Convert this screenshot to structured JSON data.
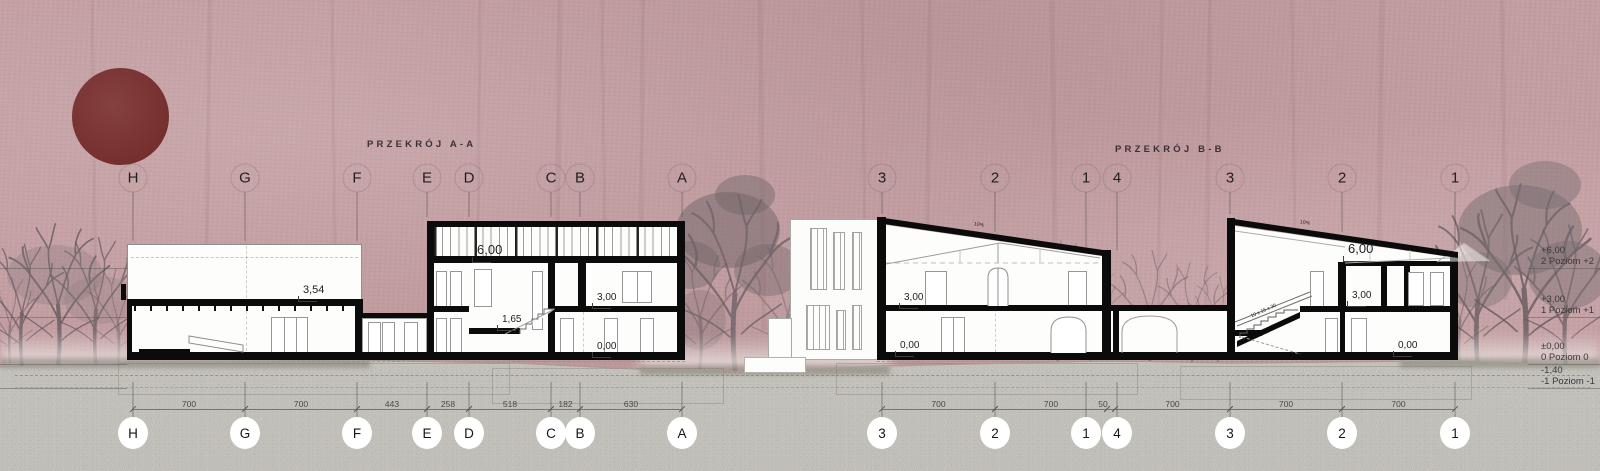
{
  "board": {
    "title_a": "PRZEKRÓJ A-A",
    "title_b": "PRZEKRÓJ B-B"
  },
  "colors": {
    "background": "#c29da0",
    "sun": "#75302f",
    "ink": "#0b0b0b",
    "ground": "#dcdbd6",
    "tree": "#6e6368",
    "birds": "#ecdfae"
  },
  "levels": {
    "rows": [
      {
        "value": "+6,00",
        "name": "2 Poziom +2",
        "y": 245
      },
      {
        "value": "+3,00",
        "name": "1 Poziom +1",
        "y": 294
      },
      {
        "value": "±0,00",
        "name": "0 Poziom 0",
        "y": 341
      },
      {
        "value": "-1,40",
        "name": "-1 Poziom -1",
        "y": 365
      }
    ]
  },
  "section_a": {
    "title_pos": {
      "x": 367,
      "y": 139
    },
    "grids": [
      {
        "label": "H",
        "x": 133,
        "drop": 241
      },
      {
        "label": "G",
        "x": 245,
        "drop": 241
      },
      {
        "label": "F",
        "x": 357,
        "drop": 241
      },
      {
        "label": "E",
        "x": 427,
        "drop": 217
      },
      {
        "label": "D",
        "x": 469,
        "drop": 217
      },
      {
        "label": "C",
        "x": 551,
        "drop": 217
      },
      {
        "label": "B",
        "x": 580,
        "drop": 217
      },
      {
        "label": "A",
        "x": 682,
        "drop": 217
      }
    ],
    "dims": [
      {
        "label": "700",
        "x1": 133,
        "x2": 245
      },
      {
        "label": "700",
        "x1": 245,
        "x2": 357
      },
      {
        "label": "443",
        "x1": 357,
        "x2": 427
      },
      {
        "label": "258",
        "x1": 427,
        "x2": 469
      },
      {
        "label": "518",
        "x1": 469,
        "x2": 551
      },
      {
        "label": "182",
        "x1": 551,
        "x2": 580
      },
      {
        "label": "630",
        "x1": 580,
        "x2": 682
      }
    ],
    "marks": [
      {
        "text": "3,54",
        "x": 303,
        "y": 284,
        "fs": 11,
        "tick": true
      },
      {
        "text": "6,00",
        "x": 477,
        "y": 242,
        "fs": 13,
        "tick": true
      },
      {
        "text": "3,00",
        "x": 597,
        "y": 292,
        "fs": 10,
        "tick": true
      },
      {
        "text": "1,65",
        "x": 502,
        "y": 314,
        "fs": 10,
        "tick": true
      },
      {
        "text": "0,00",
        "x": 597,
        "y": 341,
        "fs": 10,
        "tick": true
      }
    ]
  },
  "section_b": {
    "title_pos": {
      "x": 1115,
      "y": 144
    },
    "grids": [
      {
        "label": "3",
        "x": 882,
        "drop": 214
      },
      {
        "label": "2",
        "x": 995,
        "drop": 232
      },
      {
        "label": "1",
        "x": 1086,
        "drop": 247
      },
      {
        "label": "4",
        "x": 1117,
        "drop": 250
      },
      {
        "label": "3",
        "x": 1230,
        "drop": 214
      },
      {
        "label": "2",
        "x": 1342,
        "drop": 232
      },
      {
        "label": "1",
        "x": 1455,
        "drop": 250
      }
    ],
    "dims": [
      {
        "label": "700",
        "x1": 882,
        "x2": 995
      },
      {
        "label": "700",
        "x1": 995,
        "x2": 1107
      },
      {
        "label": "50",
        "x1": 1107,
        "x2": 1115,
        "dx": -8
      },
      {
        "label": "700",
        "x1": 1115,
        "x2": 1230
      },
      {
        "label": "700",
        "x1": 1230,
        "x2": 1342
      },
      {
        "label": "700",
        "x1": 1342,
        "x2": 1455
      }
    ],
    "marks": [
      {
        "text": "3,00",
        "x": 904,
        "y": 292,
        "fs": 10,
        "tick": true
      },
      {
        "text": "0,00",
        "x": 900,
        "y": 340,
        "fs": 10,
        "tick": true
      },
      {
        "text": "10%",
        "x": 974,
        "y": 222,
        "fs": 5,
        "rot": 8,
        "tick": false
      },
      {
        "text": "6,00",
        "x": 1348,
        "y": 241,
        "fs": 13,
        "tick": true
      },
      {
        "text": "3,00",
        "x": 1352,
        "y": 290,
        "fs": 10,
        "tick": true
      },
      {
        "text": "0,00",
        "x": 1398,
        "y": 340,
        "fs": 10,
        "tick": true
      },
      {
        "text": "10%",
        "x": 1300,
        "y": 220,
        "fs": 5,
        "rot": 8,
        "tick": false
      },
      {
        "text": "10 x 15 x 30",
        "x": 1250,
        "y": 308,
        "fs": 5,
        "rot": -24,
        "tick": false
      }
    ]
  },
  "decor": {
    "birds": [
      [
        97,
        50,
        -30
      ],
      [
        106,
        60,
        -15
      ],
      [
        113,
        70,
        -35
      ],
      [
        116,
        80,
        -20
      ],
      [
        119,
        91,
        -30
      ],
      [
        117,
        101,
        -15
      ],
      [
        123,
        112,
        -25
      ],
      [
        131,
        123,
        -30
      ],
      [
        138,
        133,
        -18
      ],
      [
        146,
        147,
        -25
      ],
      [
        156,
        155,
        -15
      ],
      [
        168,
        161,
        -22
      ],
      [
        182,
        166,
        -12
      ],
      [
        197,
        170,
        -20
      ],
      [
        211,
        172,
        -10
      ]
    ],
    "trail": {
      "x1": 16,
      "x2": 232,
      "y": 169,
      "step": 7
    }
  }
}
